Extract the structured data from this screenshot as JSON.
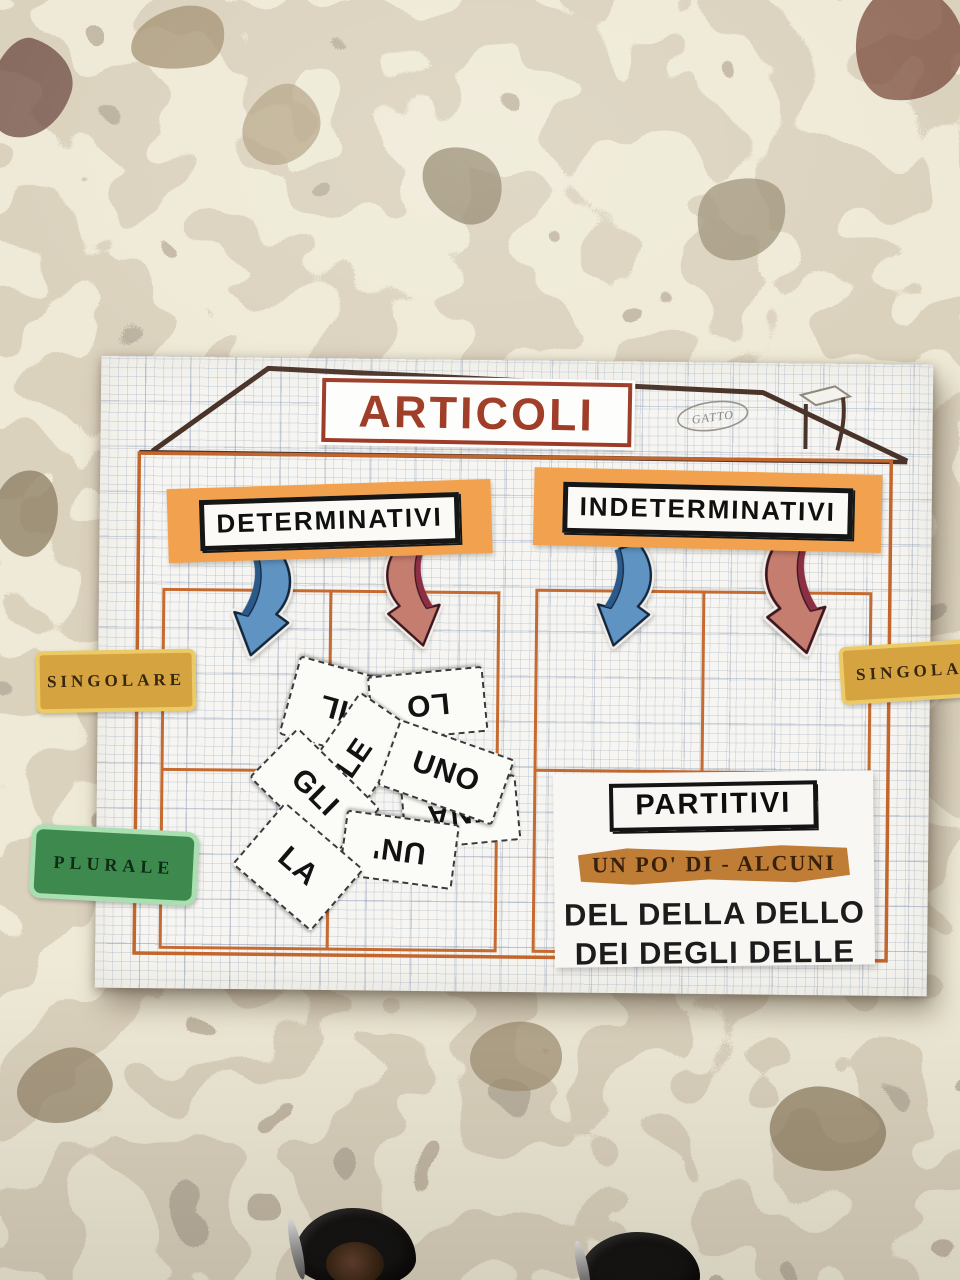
{
  "poster": {
    "title": "ARTICOLI",
    "note": "GATTO",
    "determinativi_label": "DETERMINATIVI",
    "indeterminativi_label": "INDETERMINATIVI",
    "side_labels": {
      "left_top": "SINGOLARE",
      "left_bottom": "PLURALE",
      "right_top": "SINGOLARE"
    },
    "article_cards": [
      "IL",
      "LO",
      "LE",
      "UNO",
      "UNA",
      "GLI",
      "UN'",
      "LA"
    ],
    "partitivi": {
      "title": "PARTITIVI",
      "highlight": "UN PO' DI - ALCUNI",
      "lines": [
        "DEL DELLA DELLO",
        "DEI DEGLI DELLE"
      ]
    },
    "colors": {
      "title_red": "#9e3b26",
      "category_card_orange": "#f2a24e",
      "grid_line_orange": "#c2662e",
      "roof_brown": "#4a342a",
      "arrow_blue": "#5f93c2",
      "arrow_red": "#c47d6e",
      "singolare_gold": "#d5a440",
      "plurale_green": "#3e8a4e",
      "partitivi_highlight_ochre": "#bf7d36"
    }
  }
}
